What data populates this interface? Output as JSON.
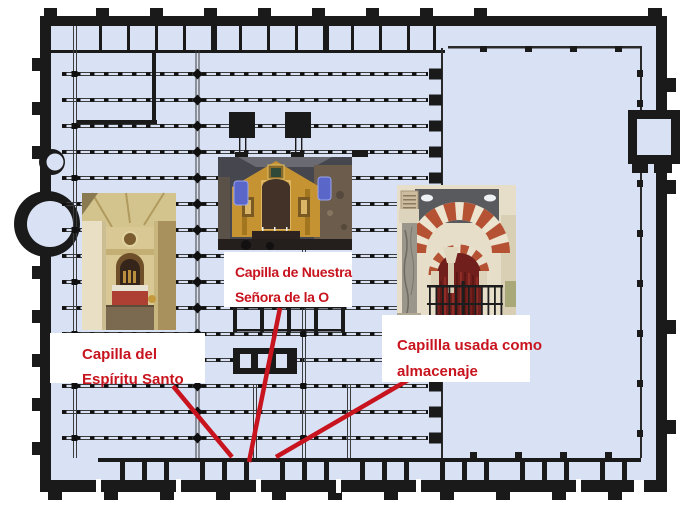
{
  "figure": {
    "name": "Mosque-Cathedral floor plan with chapel annotations",
    "colors": {
      "background": "#ffffff",
      "plan_interior": "#d9e2f5",
      "plan_walls": "#1a1a1a",
      "annotation_red": "#c8141e",
      "label_background": "#ffffff"
    }
  },
  "annotations": [
    {
      "id": "espiritu-santo",
      "line1": "Capilla del",
      "line2": "Espíritu Santo",
      "photo_alt": "baroque-chapel-interior-with-red-altar"
    },
    {
      "id": "nuestra-senora-de-la-o",
      "line1": "Capilla de Nuestra",
      "line2": "Señora de la O",
      "photo_alt": "golden-altarpiece-with-blue-windows"
    },
    {
      "id": "almacenaje",
      "line1": "Capillla usada como",
      "line2": "almacenaje",
      "photo_alt": "moorish-striped-arches-with-red-curtain-and-railing"
    }
  ]
}
